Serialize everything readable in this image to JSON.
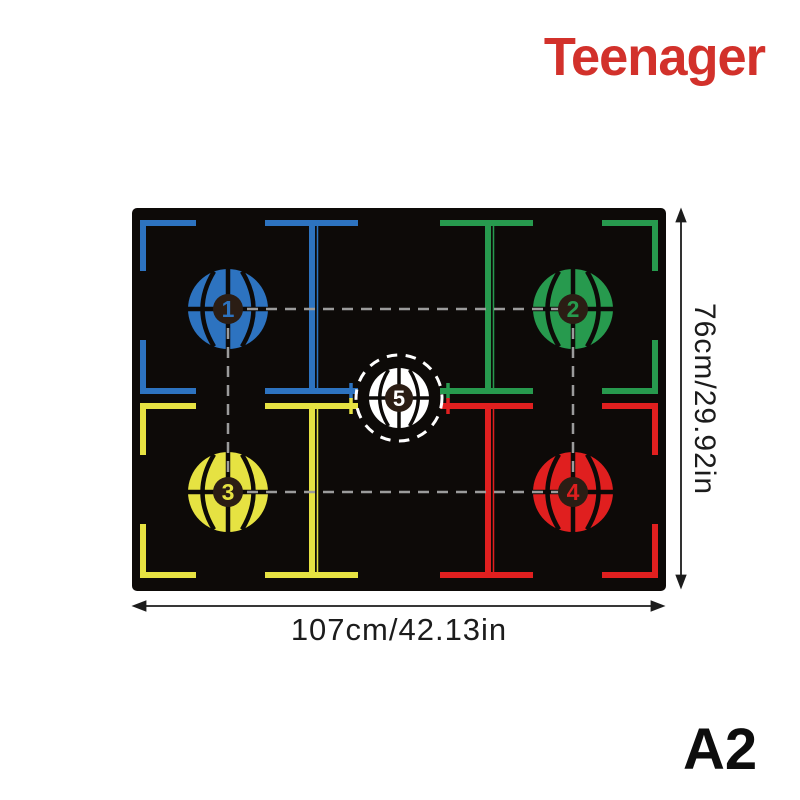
{
  "brand": {
    "label": "Teenager",
    "color": "#d2312b"
  },
  "size_code": "A2",
  "dimensions": {
    "width_label": "107cm/42.13in",
    "height_label": "76cm/29.92in"
  },
  "colors": {
    "brand_red": "#d2312b",
    "mat_black": "#0d0a08",
    "blue": "#2d73c0",
    "green": "#279a4e",
    "yellow": "#e6e242",
    "red": "#e01f1f",
    "white": "#ffffff",
    "ball_center": "#2b1d14",
    "dash_gray": "#9b9b9b",
    "ink": "#1c1c1c"
  },
  "mat": {
    "balls": [
      {
        "number": "1",
        "color": "blue",
        "position": "top-left"
      },
      {
        "number": "2",
        "color": "green",
        "position": "top-right"
      },
      {
        "number": "3",
        "color": "yellow",
        "position": "bottom-left"
      },
      {
        "number": "4",
        "color": "red",
        "position": "bottom-right"
      },
      {
        "number": "5",
        "color": "white",
        "position": "center"
      }
    ]
  }
}
